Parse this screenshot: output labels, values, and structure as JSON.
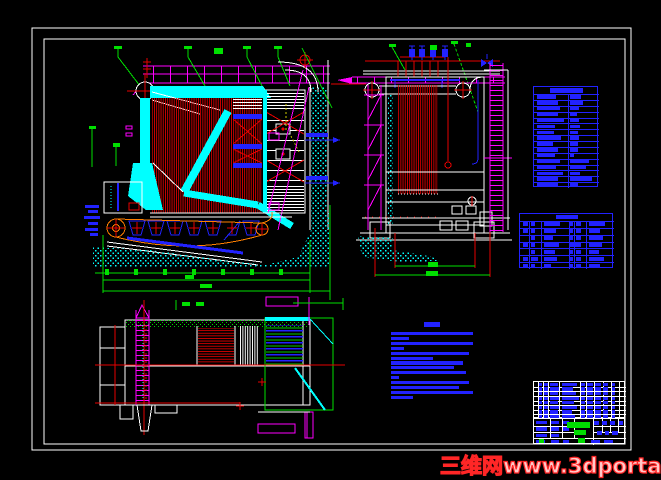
{
  "watermark": {
    "text": "三维网www.3dportal.cn",
    "outline_color": "#ff2626",
    "fill_color": "#ffc9c9"
  },
  "colors": {
    "background": "#000000",
    "frame": "#ffffff",
    "tube_red": "#e60000",
    "wall_cyan": "#00ffff",
    "platform_magenta": "#ff00ff",
    "dimension_green": "#00e000",
    "table_blue": "#2222ff",
    "chain_orange": "#ff7f00",
    "hidden_yellow": "#cccc00"
  },
  "notes": {
    "x": 391,
    "y": 322,
    "w": 84,
    "color": "#2222ff",
    "title": {
      "x": 33,
      "w": 16,
      "h": 5
    },
    "start_y": 10,
    "pitch": 4.9,
    "line_h": 3.2,
    "widths": [
      82,
      18,
      82,
      13,
      78,
      42,
      72,
      63,
      75,
      8,
      78,
      68,
      82,
      22
    ]
  },
  "tables": {
    "spec_table": {
      "x": 533,
      "y": 86,
      "w": 65,
      "h": 101,
      "line": "#2222ff",
      "text": "#2222ff",
      "hlines": [
        [
          0.07,
          0,
          1
        ],
        [
          0.128,
          0,
          1
        ],
        [
          0.186,
          0,
          1
        ],
        [
          0.244,
          0,
          1
        ],
        [
          0.302,
          0,
          1
        ],
        [
          0.361,
          0,
          1
        ],
        [
          0.419,
          0,
          1
        ],
        [
          0.477,
          0,
          1
        ],
        [
          0.535,
          0,
          1
        ],
        [
          0.593,
          0,
          1
        ],
        [
          0.651,
          0,
          1
        ],
        [
          0.71,
          0,
          1
        ],
        [
          0.768,
          0,
          1
        ],
        [
          0.826,
          0,
          1
        ],
        [
          0.884,
          0,
          1
        ],
        [
          0.942,
          0,
          1
        ]
      ],
      "vlines": [
        [
          0.52,
          0.07,
          1
        ]
      ],
      "blocks": [
        [
          0.25,
          0.012,
          0.5,
          0.045
        ]
      ],
      "autoRows": {
        "tops": [
          0.07,
          0.128,
          0.186,
          0.244,
          0.302,
          0.361,
          0.419,
          0.477,
          0.535,
          0.593,
          0.651,
          0.71,
          0.768,
          0.826,
          0.884,
          0.942
        ],
        "pad": 0.012,
        "h": 0.034,
        "cols": [
          0.045,
          0.56
        ]
      },
      "rowBlocks": [
        [
          0.3,
          0.17
        ],
        [
          0.33,
          0.2
        ],
        [
          0.35,
          0.14
        ],
        [
          0.33,
          0.1
        ],
        [
          0.42,
          0.14
        ],
        [
          0.28,
          0.15
        ],
        [
          0.26,
          0.11
        ],
        [
          0.37,
          0.14
        ],
        [
          0.24,
          0.12
        ],
        [
          0.32,
          0.12
        ],
        [
          0.28,
          0.06
        ],
        [
          0.35,
          0.28
        ],
        [
          0.3,
          0.24
        ],
        [
          0.4,
          0.15
        ],
        [
          0.33,
          0.33
        ],
        [
          0.32,
          0.11
        ]
      ]
    },
    "parts_mid_table": {
      "x": 519,
      "y": 213,
      "w": 94,
      "h": 55,
      "line": "#2222ff",
      "text": "#2222ff",
      "hlines": [
        [
          0.125,
          0,
          1
        ],
        [
          0.25,
          0,
          1
        ],
        [
          0.375,
          0,
          1
        ],
        [
          0.5,
          0,
          1
        ],
        [
          0.625,
          0,
          1
        ],
        [
          0.75,
          0,
          1
        ],
        [
          0.875,
          0,
          1
        ]
      ],
      "vlines": [
        [
          0.095,
          0.125,
          1
        ],
        [
          0.22,
          0.125,
          1
        ],
        [
          0.52,
          0.125,
          1
        ],
        [
          0.57,
          0.125,
          1
        ],
        [
          0.7,
          0.125,
          1
        ]
      ],
      "blocks": [
        [
          0.38,
          0.02,
          0.24,
          0.08
        ]
      ],
      "autoRows": {
        "tops": [
          0.125,
          0.25,
          0.375,
          0.5,
          0.625,
          0.75,
          0.875
        ],
        "pad": 0.025,
        "h": 0.075,
        "cols": [
          0.035,
          0.115,
          0.25,
          0.53,
          0.6,
          0.73
        ]
      },
      "rowBlocks": [
        [
          0.05,
          0.05,
          0.18,
          0.035,
          0.05,
          0.17
        ],
        [
          0.05,
          0.05,
          0.13,
          0.035,
          0.05,
          0.12
        ],
        [
          0,
          0.05,
          0.1,
          0.035,
          0.05,
          0.15
        ],
        [
          0.05,
          0.05,
          0.16,
          0.12,
          0,
          0.14
        ],
        [
          0,
          0.05,
          0.12,
          0.035,
          0.05,
          0.11
        ],
        [
          0.05,
          0.08,
          0.14,
          0.035,
          0.05,
          0.16
        ],
        [
          0.05,
          0.05,
          0.08,
          0.035,
          0.05,
          0.12
        ]
      ]
    },
    "parts_list": {
      "x": 533,
      "y": 381,
      "w": 92,
      "h": 37,
      "line": "#ffffff",
      "text": "#2222ff",
      "hlines": [
        [
          0.125,
          0,
          1
        ],
        [
          0.25,
          0,
          1
        ],
        [
          0.375,
          0,
          1
        ],
        [
          0.5,
          0,
          1
        ],
        [
          0.625,
          0,
          1
        ],
        [
          0.75,
          0,
          1
        ],
        [
          0.875,
          0,
          1
        ]
      ],
      "vlines": [
        [
          0.04,
          0,
          1
        ],
        [
          0.1,
          0,
          1
        ],
        [
          0.155,
          0,
          1
        ],
        [
          0.27,
          0,
          1
        ],
        [
          0.5,
          0,
          1
        ],
        [
          0.565,
          0,
          1
        ],
        [
          0.655,
          0,
          1
        ],
        [
          0.745,
          0,
          1
        ],
        [
          0.835,
          0,
          1
        ],
        [
          0.92,
          0,
          1
        ]
      ],
      "autoRows": {
        "tops": [
          0,
          0.125,
          0.25,
          0.375,
          0.5,
          0.625,
          0.75,
          0.875
        ],
        "pad": 0.02,
        "h": 0.085,
        "cols": [
          0.05,
          0.108,
          0.17,
          0.3,
          0.51,
          0.575,
          0.665,
          0.755,
          0.845
        ]
      },
      "rowBlocks": [
        [
          0.035,
          0.04,
          0.09,
          0.17,
          0.045,
          0.07,
          0.06,
          0.05,
          0.04
        ],
        [
          0.035,
          0.04,
          0.1,
          0.12,
          0.045,
          0.07,
          0.06,
          0.05,
          0.04
        ],
        [
          0.035,
          0.04,
          0.09,
          0.16,
          0.045,
          0.07,
          0.06,
          0.05,
          0.04
        ],
        [
          0.035,
          0.04,
          0.1,
          0.19,
          0.045,
          0.07,
          0.06,
          0.05,
          0.04
        ],
        [
          0.035,
          0.04,
          0.09,
          0.13,
          0.045,
          0.07,
          0.06,
          0.05,
          0.04
        ],
        [
          0.035,
          0.04,
          0.1,
          0.17,
          0.045,
          0.07,
          0.06,
          0.05,
          0.04
        ],
        [
          0.035,
          0.04,
          0.09,
          0.11,
          0.045,
          0.07,
          0.06,
          0.05,
          0.04
        ],
        [
          0.035,
          0.04,
          0.1,
          0.15,
          0.045,
          0.07,
          0.06,
          0.05,
          0.04
        ]
      ]
    },
    "title_block": {
      "x": 533,
      "y": 418,
      "w": 92,
      "h": 26,
      "line": "#ffffff",
      "text": "#2222ff",
      "hlines": [
        [
          0.27,
          0,
          0.44
        ],
        [
          0.27,
          0.64,
          1
        ],
        [
          0.5,
          0,
          0.44
        ],
        [
          0.5,
          0.64,
          1
        ],
        [
          0.74,
          0,
          1
        ]
      ],
      "vlines": [
        [
          0.17,
          0,
          0.74
        ],
        [
          0.3,
          0,
          0.74
        ],
        [
          0.44,
          0,
          0.74
        ],
        [
          0.64,
          0,
          1
        ],
        [
          0.735,
          0,
          0.5
        ],
        [
          0.825,
          0,
          0.5
        ],
        [
          0.915,
          0,
          0.5
        ]
      ],
      "blocks": [
        [
          0.02,
          0.06,
          0.12,
          0.15
        ],
        [
          0.185,
          0.06,
          0.09,
          0.15
        ],
        [
          0.315,
          0.06,
          0.07,
          0.15
        ],
        [
          0.02,
          0.32,
          0.12,
          0.15
        ],
        [
          0.185,
          0.32,
          0.09,
          0.15
        ],
        [
          0.315,
          0.32,
          0.07,
          0.15
        ],
        [
          0.02,
          0.56,
          0.12,
          0.15
        ],
        [
          0.185,
          0.56,
          0.09,
          0.15
        ],
        [
          0.02,
          0.8,
          0.1,
          0.14
        ],
        [
          0.185,
          0.8,
          0.09,
          0.14
        ],
        [
          0.315,
          0.8,
          0.07,
          0.14
        ],
        [
          0.655,
          0.08,
          0.05,
          0.14
        ],
        [
          0.74,
          0.08,
          0.05,
          0.14
        ],
        [
          0.83,
          0.08,
          0.05,
          0.14
        ],
        [
          0.92,
          0.08,
          0.05,
          0.14
        ],
        [
          0.69,
          0.48,
          0.05,
          0.15
        ],
        [
          0.77,
          0.48,
          0.05,
          0.15
        ],
        [
          0.85,
          0.48,
          0.06,
          0.15
        ],
        [
          0.62,
          0.8,
          0.1,
          0.14
        ],
        [
          0.76,
          0.8,
          0.1,
          0.14
        ],
        [
          0.359,
          0.115,
          0.25,
          0.22,
          "#00dd00"
        ],
        [
          0.435,
          0.42,
          0.13,
          0.19,
          "#00dd00"
        ],
        [
          0.05,
          0.77,
          0.055,
          0.16,
          "#00dd00"
        ],
        [
          0.478,
          0.73,
          0.08,
          0.2,
          "#00dd00"
        ]
      ]
    }
  }
}
